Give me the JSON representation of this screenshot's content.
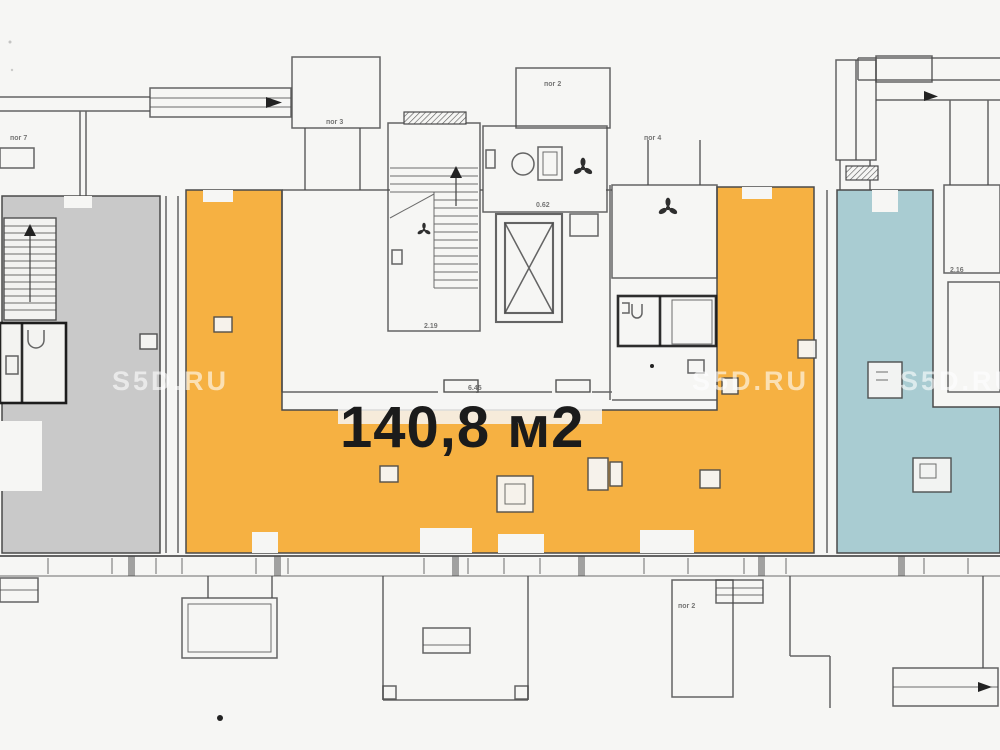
{
  "plan": {
    "type": "scanned-floor-plan",
    "area_label": "140,8 м2",
    "watermark": "S5D.RU",
    "labels": [
      {
        "text": "пог 7"
      },
      {
        "text": "пог 3"
      },
      {
        "text": "пог 2"
      },
      {
        "text": "пог 4"
      },
      {
        "text": "пог 2"
      },
      {
        "text": "2.19"
      },
      {
        "text": "6.45"
      },
      {
        "text": "0.62"
      },
      {
        "text": "2.16"
      }
    ],
    "colors": {
      "highlight_orange": "#F6B143",
      "area_gray": "#C9C9C9",
      "area_blue": "#A9CCD2",
      "wall_line": "#4A4A4A",
      "label_text": "#1B1B1B",
      "paper": "#F6F6F4",
      "watermark_white": "#FFFFFF"
    }
  }
}
